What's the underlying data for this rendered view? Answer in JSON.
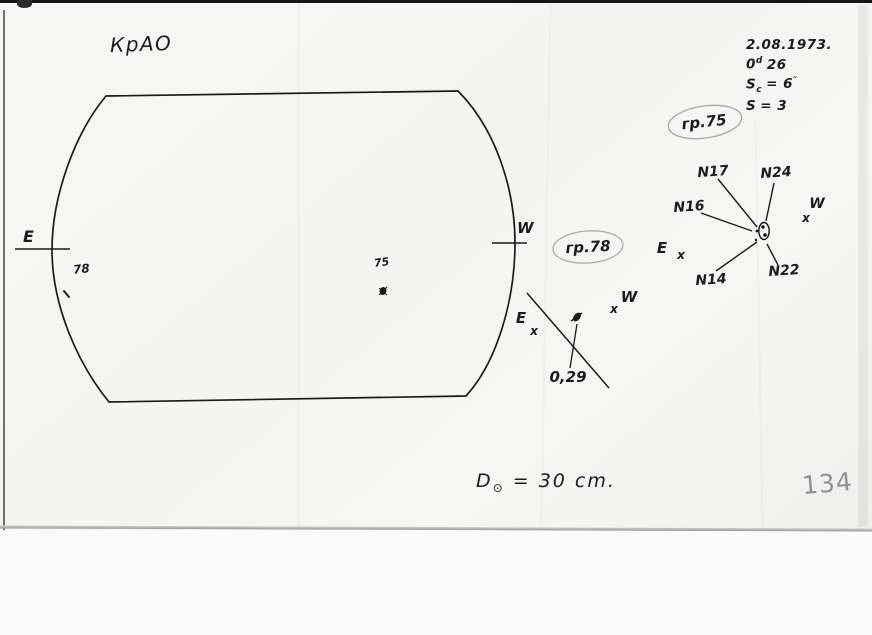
{
  "header": {
    "observatory": "КрАО"
  },
  "obs_info": {
    "date": "2.08.1973.",
    "time_base": "0",
    "time_sup": "d",
    "time_rest": "26",
    "seeing_label": "S",
    "seeing_sub": "c",
    "seeing_eq": "= 6",
    "seeing_sup": "″",
    "s_label": "S",
    "s_value": "= 3"
  },
  "disk": {
    "east_label": "E",
    "west_label": "W",
    "spot78_label": "78",
    "spot75_label": "75",
    "diameter_d": "D",
    "diameter_symbol": "⊙",
    "diameter_value": "= 30 cm."
  },
  "group75": {
    "tag": "гр.75",
    "spots": [
      "N17",
      "N24",
      "N16",
      "N14",
      "N22"
    ],
    "east_label": "E",
    "east_mark": "x",
    "west_label": "W",
    "west_mark": "x"
  },
  "group78": {
    "tag": "гр.78",
    "measure": "0,29",
    "east_label": "E",
    "east_mark": "x",
    "west_label": "W",
    "west_mark": "x"
  },
  "scan": {
    "page_number": "134"
  }
}
